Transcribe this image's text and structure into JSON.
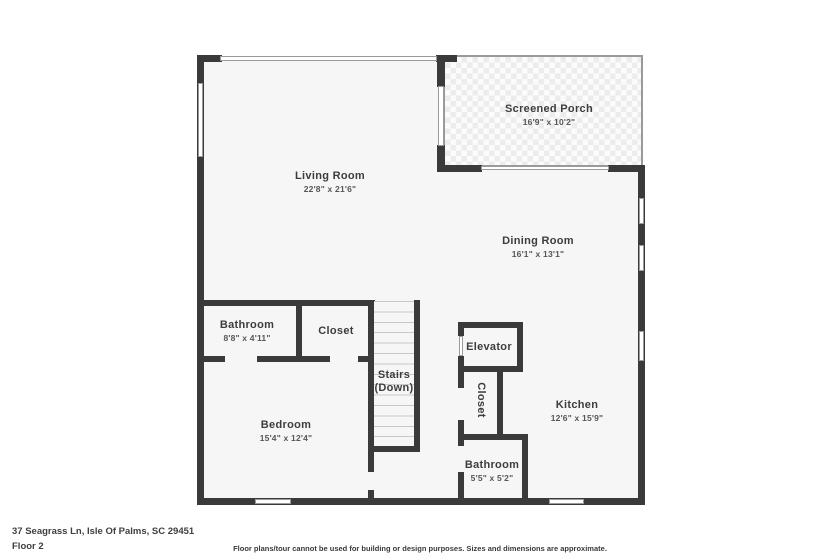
{
  "page": {
    "address": "37 Seagrass Ln, Isle Of Palms, SC 29451",
    "floor_label": "Floor 2",
    "disclaimer": "Floor plans/tour cannot be used for building or design purposes. Sizes and dimensions are approximate."
  },
  "rooms": {
    "living_room": {
      "name": "Living Room",
      "dims": "22'8\" x 21'6\""
    },
    "screened_porch": {
      "name": "Screened Porch",
      "dims": "16'9\" x 10'2\""
    },
    "dining_room": {
      "name": "Dining Room",
      "dims": "16'1\" x 13'1\""
    },
    "bathroom_upper": {
      "name": "Bathroom",
      "dims": "8'8\" x 4'11\""
    },
    "closet_upper": {
      "name": "Closet"
    },
    "stairs": {
      "name": "Stairs",
      "sub": "(Down)"
    },
    "elevator": {
      "name": "Elevator"
    },
    "closet_hall": {
      "name": "Closet"
    },
    "kitchen": {
      "name": "Kitchen",
      "dims": "12'6\" x 15'9\""
    },
    "bedroom": {
      "name": "Bedroom",
      "dims": "15'4\" x 12'4\""
    },
    "bathroom_lower": {
      "name": "Bathroom",
      "dims": "5'5\" x 5'2\""
    }
  },
  "colors": {
    "wall": "#3a3a3a",
    "floor_fill": "#f6f6f6",
    "porch_check": "#ececec",
    "window_border": "#9a9a9a",
    "text": "#3d3d3d"
  }
}
